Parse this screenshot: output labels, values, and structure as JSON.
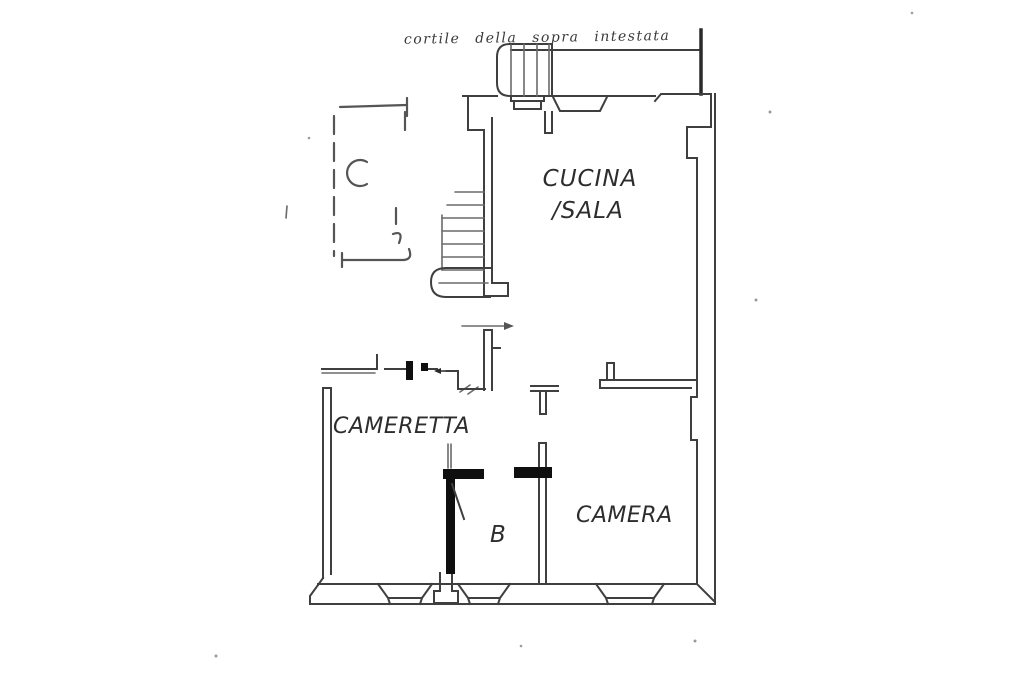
{
  "annotation": {
    "handwritten_note": "cortile della sopra intestata"
  },
  "rooms": {
    "kitchen_living": {
      "label_line1": "CUCINA",
      "label_line2": "/SALA"
    },
    "small_bedroom": {
      "label": "CAMERETTA"
    },
    "bedroom": {
      "label": "CAMERA"
    },
    "bathroom": {
      "label": "B"
    }
  },
  "colors": {
    "wall_line": "#3f3f3f",
    "light_line": "#6a6a6a",
    "door_marker": "#0f0f0f",
    "label_text": "#2d2d2d",
    "handwriting": "#3a3a3a",
    "background": "#ffffff"
  }
}
